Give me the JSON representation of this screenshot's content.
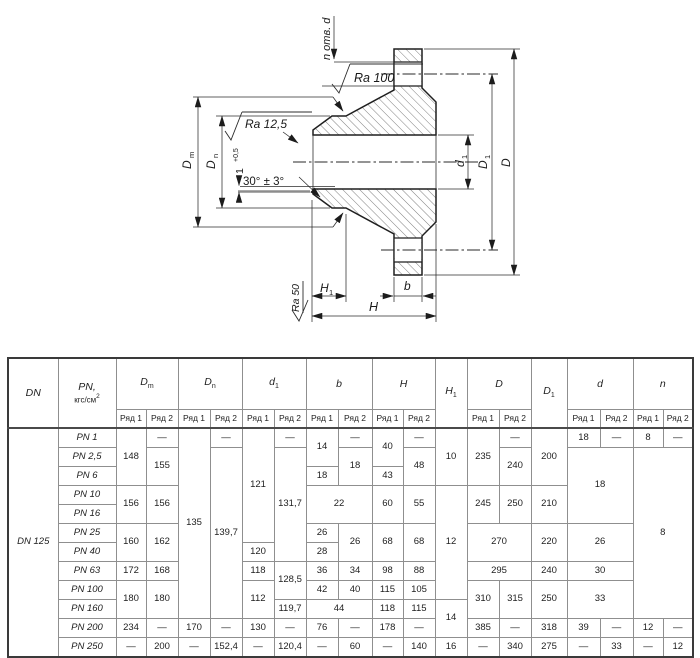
{
  "drawing": {
    "labels": {
      "n_holes": "n отв. d",
      "ra100": "Ra 100",
      "ra125": "Ra 12,5",
      "ra50": "Ra 50",
      "angle": "30° ± 3°",
      "root": "1",
      "root_tol": "+0,5",
      "dm": "D",
      "dm_s": "m",
      "dn": "D",
      "dn_s": "n",
      "d1": "d",
      "d1_s": "1",
      "dd": "D",
      "dd1": "D",
      "dd1_s": "1",
      "h": "H",
      "h1": "H",
      "h1_s": "1",
      "b": "b"
    },
    "line_color": "#222222",
    "hatch_color": "#4a4a4a"
  },
  "table": {
    "columns": [
      {
        "label": "DN",
        "split": false
      },
      {
        "label": "PN,",
        "line2": "кгс/см",
        "sup": "2",
        "split": false
      },
      {
        "label": "D",
        "sub": "m",
        "split": true
      },
      {
        "label": "D",
        "sub": "n",
        "split": true
      },
      {
        "label": "d",
        "sub": "1",
        "split": true
      },
      {
        "label": "b",
        "split": true
      },
      {
        "label": "H",
        "split": true
      },
      {
        "label": "H",
        "sub": "1",
        "split": false
      },
      {
        "label": "D",
        "split": true
      },
      {
        "label": "D",
        "sub": "1",
        "split": false
      },
      {
        "label": "d",
        "split": true
      },
      {
        "label": "n",
        "split": true
      }
    ],
    "subheader_labels": [
      "Ряд 1",
      "Ряд 2"
    ],
    "body": [
      [
        {
          "t": "DN 125",
          "rs": 12,
          "lbl": true
        },
        {
          "t": "PN 1",
          "lbl": true
        },
        {
          "t": "148",
          "rs": 3
        },
        {
          "t": "—"
        },
        {
          "t": "135",
          "rs": 10
        },
        {
          "t": "—"
        },
        {
          "t": "121",
          "rs": 6
        },
        {
          "t": "—"
        },
        {
          "t": "14",
          "rs": 2
        },
        {
          "t": "—"
        },
        {
          "t": "40",
          "rs": 2
        },
        {
          "t": "—"
        },
        {
          "t": "10",
          "rs": 3
        },
        {
          "t": "235",
          "rs": 3
        },
        {
          "t": "—"
        },
        {
          "t": "200",
          "rs": 3
        },
        {
          "t": "18"
        },
        {
          "t": "—"
        },
        {
          "t": "8"
        },
        {
          "t": "—"
        }
      ],
      [
        {
          "t": "PN 2,5",
          "lbl": true
        },
        {
          "t": "155",
          "rs": 2
        },
        {
          "t": "139,7",
          "rs": 9
        },
        {
          "t": "131,7",
          "rs": 6
        },
        {
          "t": "18",
          "rs": 2
        },
        {
          "t": "48",
          "rs": 2
        },
        {
          "t": "240",
          "rs": 2
        },
        {
          "t": "18",
          "rs": 4,
          "cs": 2
        },
        {
          "t": "8",
          "rs": 9,
          "cs": 2
        }
      ],
      [
        {
          "t": "PN 6",
          "lbl": true
        },
        {
          "t": "18"
        },
        {
          "t": "43"
        }
      ],
      [
        {
          "t": "PN 10",
          "lbl": true
        },
        {
          "t": "156",
          "rs": 2
        },
        {
          "t": "156",
          "rs": 2
        },
        {
          "t": "22",
          "rs": 2,
          "cs": 2
        },
        {
          "t": "60",
          "rs": 2
        },
        {
          "t": "55",
          "rs": 2
        },
        {
          "t": "12",
          "rs": 6
        },
        {
          "t": "245",
          "rs": 2
        },
        {
          "t": "250",
          "rs": 2
        },
        {
          "t": "210",
          "rs": 2
        }
      ],
      [
        {
          "t": "PN 16",
          "lbl": true
        }
      ],
      [
        {
          "t": "PN 25",
          "lbl": true
        },
        {
          "t": "160",
          "rs": 2
        },
        {
          "t": "162",
          "rs": 2
        },
        {
          "t": "26"
        },
        {
          "t": "26",
          "rs": 2
        },
        {
          "t": "68",
          "rs": 2
        },
        {
          "t": "68",
          "rs": 2
        },
        {
          "t": "270",
          "rs": 2,
          "cs": 2
        },
        {
          "t": "220",
          "rs": 2
        },
        {
          "t": "26",
          "rs": 2,
          "cs": 2
        }
      ],
      [
        {
          "t": "PN 40",
          "lbl": true
        },
        {
          "t": "120"
        },
        {
          "t": "28"
        }
      ],
      [
        {
          "t": "PN 63",
          "lbl": true
        },
        {
          "t": "172"
        },
        {
          "t": "168"
        },
        {
          "t": "118"
        },
        {
          "t": "128,5",
          "rs": 2
        },
        {
          "t": "36"
        },
        {
          "t": "34"
        },
        {
          "t": "98"
        },
        {
          "t": "88"
        },
        {
          "t": "295",
          "cs": 2
        },
        {
          "t": "240"
        },
        {
          "t": "30",
          "cs": 2
        }
      ],
      [
        {
          "t": "PN 100",
          "lbl": true
        },
        {
          "t": "180",
          "rs": 2
        },
        {
          "t": "180",
          "rs": 2
        },
        {
          "t": "112",
          "rs": 2
        },
        {
          "t": "42"
        },
        {
          "t": "40"
        },
        {
          "t": "115"
        },
        {
          "t": "105"
        },
        {
          "t": "310",
          "rs": 2
        },
        {
          "t": "315",
          "rs": 2
        },
        {
          "t": "250",
          "rs": 2
        },
        {
          "t": "33",
          "rs": 2,
          "cs": 2
        }
      ],
      [
        {
          "t": "PN 160",
          "lbl": true
        },
        {
          "t": "119,7"
        },
        {
          "t": "44",
          "cs": 2
        },
        {
          "t": "118"
        },
        {
          "t": "115"
        },
        {
          "t": "14",
          "rs": 2
        }
      ],
      [
        {
          "t": "PN 200",
          "lbl": true
        },
        {
          "t": "234"
        },
        {
          "t": "—"
        },
        {
          "t": "170"
        },
        {
          "t": "—"
        },
        {
          "t": "130"
        },
        {
          "t": "—"
        },
        {
          "t": "76"
        },
        {
          "t": "—"
        },
        {
          "t": "178"
        },
        {
          "t": "—"
        },
        {
          "t": "385"
        },
        {
          "t": "—"
        },
        {
          "t": "318"
        },
        {
          "t": "39"
        },
        {
          "t": "—"
        },
        {
          "t": "12"
        },
        {
          "t": "—"
        }
      ],
      [
        {
          "t": "PN 250",
          "lbl": true
        },
        {
          "t": "—"
        },
        {
          "t": "200"
        },
        {
          "t": "—"
        },
        {
          "t": "152,4"
        },
        {
          "t": "—"
        },
        {
          "t": "120,4"
        },
        {
          "t": "—"
        },
        {
          "t": "60"
        },
        {
          "t": "—"
        },
        {
          "t": "140"
        },
        {
          "t": "16"
        },
        {
          "t": "—"
        },
        {
          "t": "340"
        },
        {
          "t": "275"
        },
        {
          "t": "—"
        },
        {
          "t": "33"
        },
        {
          "t": "—"
        },
        {
          "t": "12"
        }
      ]
    ]
  }
}
